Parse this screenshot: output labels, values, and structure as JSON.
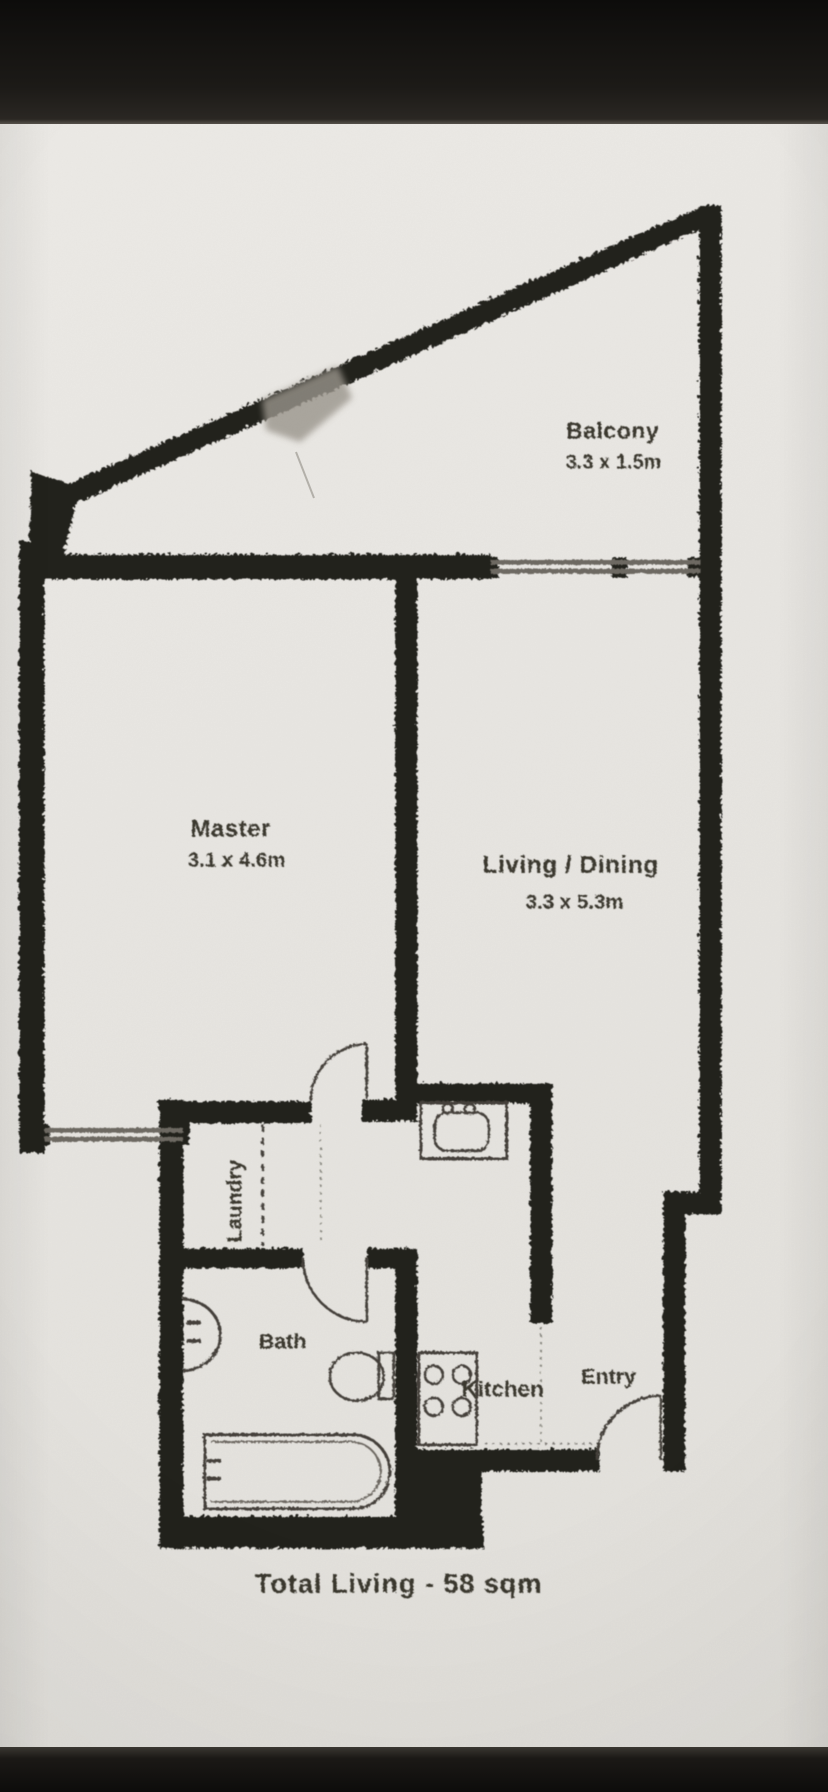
{
  "plan": {
    "rooms": {
      "balcony": {
        "label": "Balcony",
        "dims": "3.3 x 1.5m"
      },
      "master": {
        "label": "Master",
        "dims": "3.1 x 4.6m"
      },
      "living": {
        "label": "Living / Dining",
        "dims": "3.3 x 5.3m"
      },
      "laundry": {
        "label": "Laundry"
      },
      "bath": {
        "label": "Bath"
      },
      "kitchen": {
        "label": "Kitchen"
      },
      "entry": {
        "label": "Entry"
      }
    },
    "total_label": "Total Living - 58 sqm"
  },
  "colors": {
    "wall": "#23201b",
    "paper": "#e9e7e3",
    "photo_bar": "#151311",
    "ink_line": "#45413a",
    "ink_text": "#3a372f"
  }
}
